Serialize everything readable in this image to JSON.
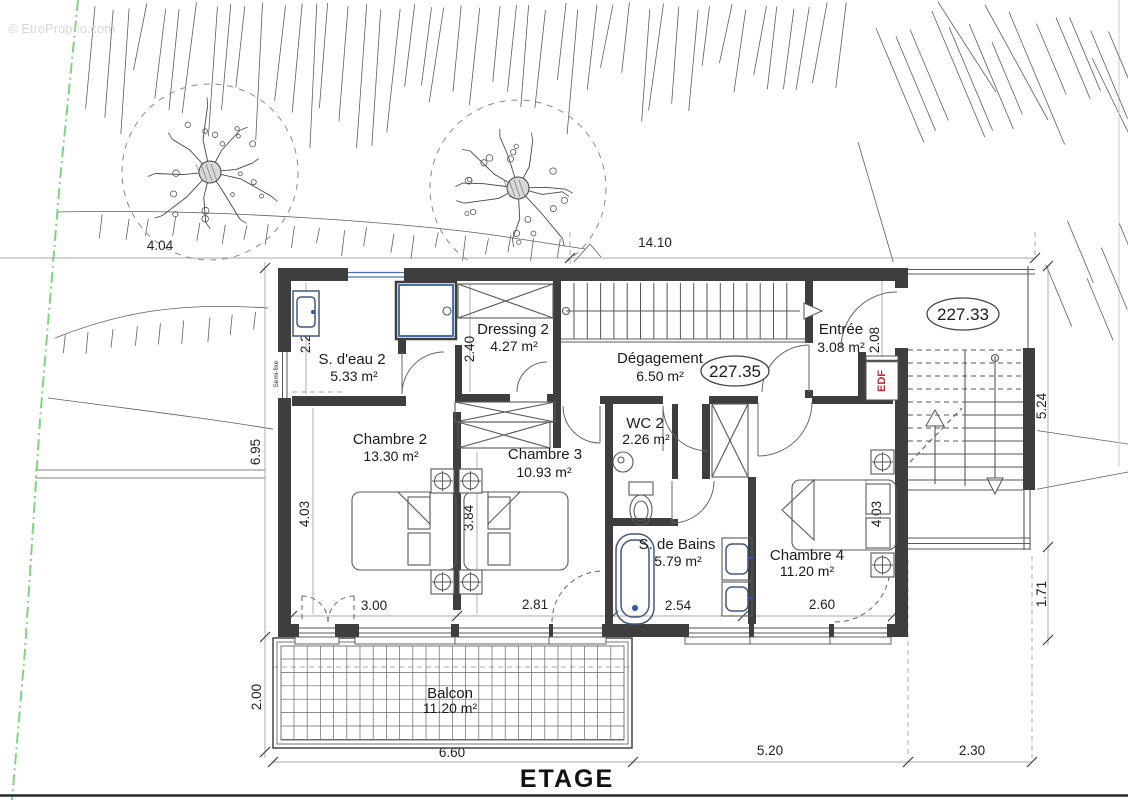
{
  "watermark": "© EtreProprio.com",
  "title": "ETAGE",
  "level_markers": {
    "landing": "227.33",
    "hall": "227.35"
  },
  "rooms": [
    {
      "name": "S. d'eau 2",
      "area": "5.33 m²"
    },
    {
      "name": "Dressing 2",
      "area": "4.27 m²"
    },
    {
      "name": "Dégagement",
      "area": "6.50 m²"
    },
    {
      "name": "Entrée",
      "area": "3.08 m²"
    },
    {
      "name": "Chambre 2",
      "area": "13.30 m²"
    },
    {
      "name": "Chambre 3",
      "area": "10.93 m²"
    },
    {
      "name": "WC 2",
      "area": "2.26 m²"
    },
    {
      "name": "S. de Bains",
      "area": "5.79 m²"
    },
    {
      "name": "Chambre 4",
      "area": "11.20 m²"
    },
    {
      "name": "Balcon",
      "area": "11.20 m²"
    }
  ],
  "dims": {
    "top_left": "4.04",
    "top_main": "14.10",
    "left_height": "6.95",
    "balcony_depth": "2.00",
    "right_height": "5.24",
    "right_lower": "1.71",
    "bottom_balcony": "6.60",
    "bottom_mid": "5.20",
    "bottom_right": "2.30",
    "sdeau_width": "2.21",
    "dressing_width": "2.40",
    "entree_width": "2.08",
    "ch2_height": "4.03",
    "ch3_height": "3.84",
    "ch4_height": "4.03",
    "ch2_width": "3.00",
    "ch3_width": "2.81",
    "bath_width": "2.54",
    "ch4_width": "2.60"
  },
  "annotations": {
    "edf": "EDF",
    "semi_fixe": "Semi-fixe"
  },
  "colors": {
    "wall": "#3e3e3e",
    "line": "#4a4a4a",
    "fixture_blue": "#44597f",
    "boundary_green": "#7cd87c",
    "edf_red": "#c22f2f",
    "watermark_gray": "#d8d8d8"
  }
}
